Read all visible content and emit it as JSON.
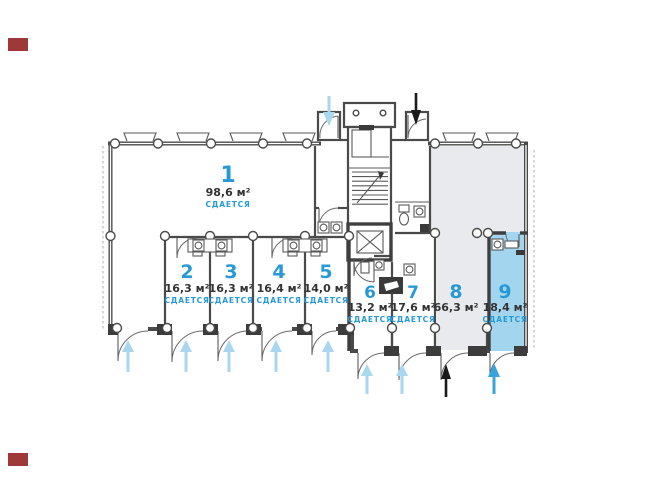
{
  "plan": {
    "rooms": [
      {
        "number": "1",
        "area": "98,6 м²",
        "status": "СДАЕТСЯ"
      },
      {
        "number": "2",
        "area": "16,3 м²",
        "status": "СДАЕТСЯ"
      },
      {
        "number": "3",
        "area": "16,3 м²",
        "status": "СДАЕТСЯ"
      },
      {
        "number": "4",
        "area": "16,4 м²",
        "status": "СДАЕТСЯ"
      },
      {
        "number": "5",
        "area": "14,0 м²",
        "status": "СДАЕТСЯ"
      },
      {
        "number": "6",
        "area": "13,2 м²",
        "status": "СДАЕТСЯ"
      },
      {
        "number": "7",
        "area": "17,6 м²",
        "status": "СДАЕТСЯ"
      },
      {
        "number": "8",
        "area": "66,3 м²",
        "status": ""
      },
      {
        "number": "9",
        "area": "18,4 м²",
        "status": "СДАЕТСЯ"
      }
    ],
    "colors": {
      "label_blue": "#2799d6",
      "area_text": "#333333",
      "room8_fill": "#e9eaed",
      "room9_fill": "#a3d6ee",
      "arrow_pale": "#a8d7ef",
      "arrow_blue": "#38a3dd",
      "arrow_black": "#1a1a1a",
      "marker_red": "#9e3939"
    }
  }
}
